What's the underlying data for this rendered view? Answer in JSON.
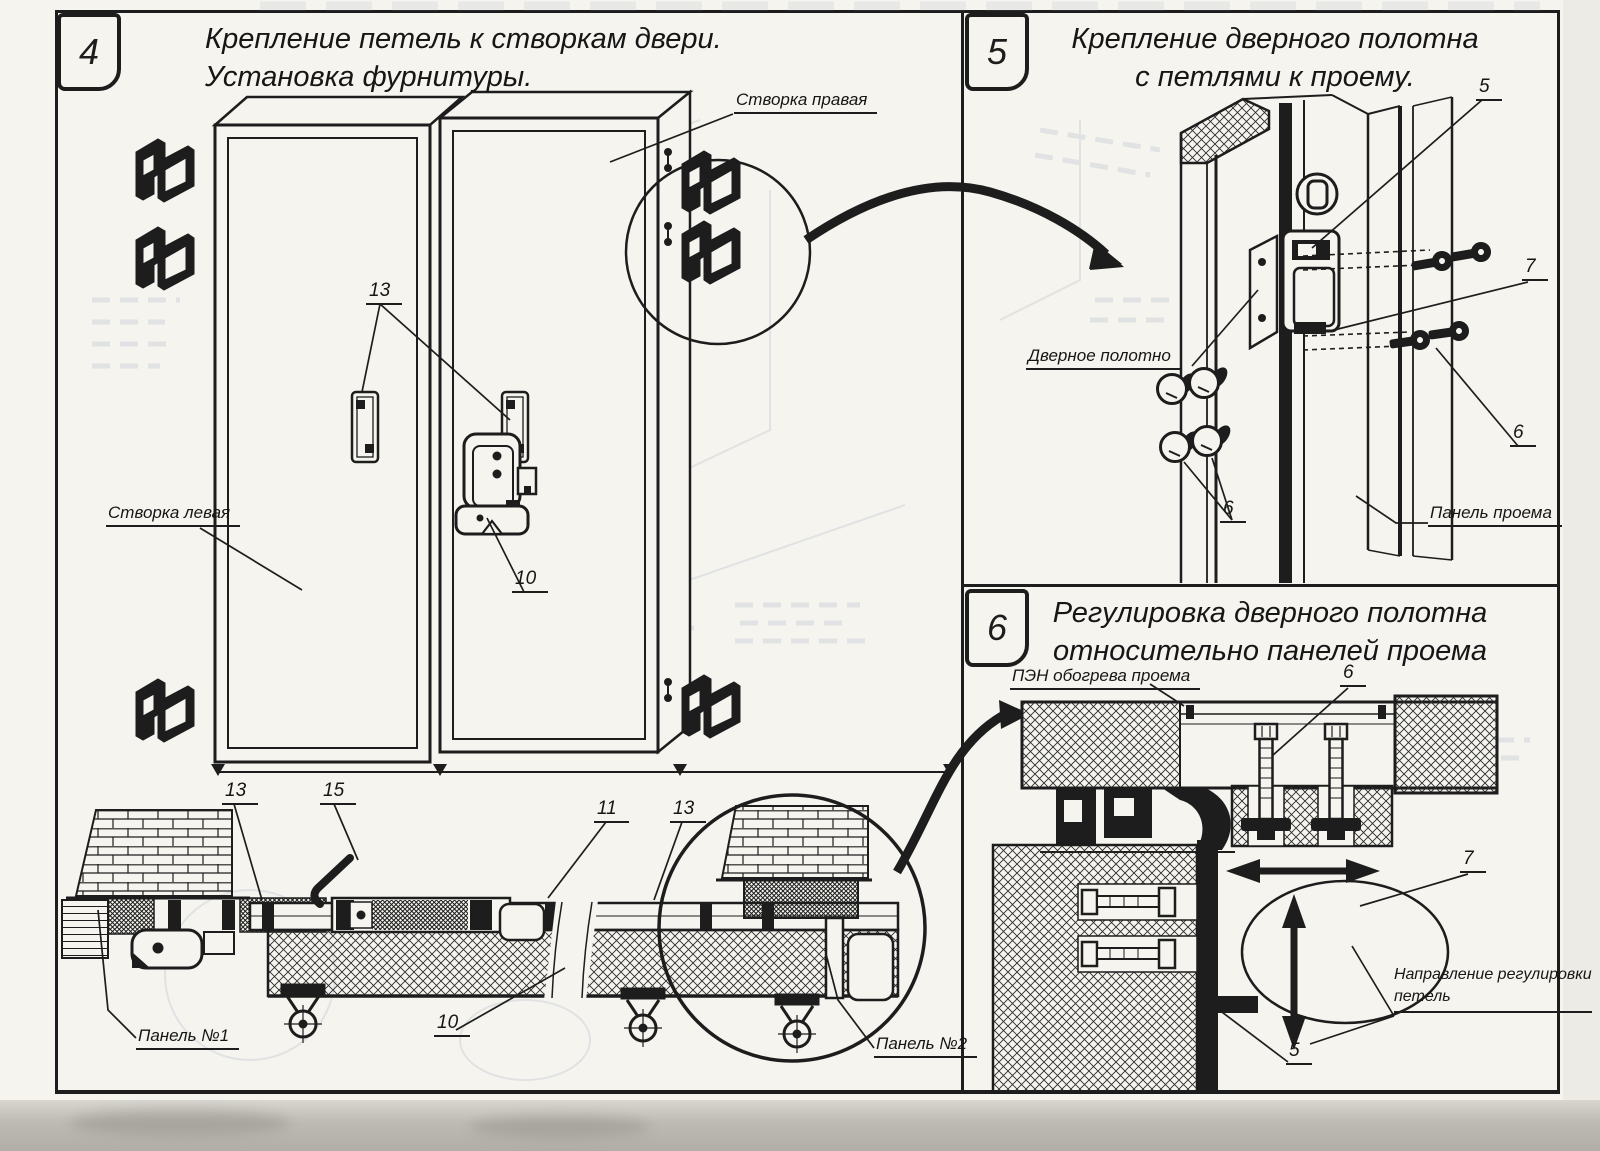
{
  "panels": {
    "panel4": {
      "number": "4",
      "title": [
        "Крепление петель к створкам двери.",
        "Установка фурнитуры."
      ],
      "labels": {
        "leaf_right": "Створка правая",
        "leaf_left": "Створка левая",
        "panel_no1": "Панель №1",
        "panel_no2": "Панель №2"
      },
      "callouts": {
        "hinge_plates": "13",
        "latch": "10",
        "bottom_13_left": "13",
        "bottom_15": "15",
        "bottom_11": "11",
        "bottom_13_right": "13",
        "bottom_10": "10"
      }
    },
    "panel5": {
      "number": "5",
      "title": [
        "Крепление дверного полотна",
        "с петлями к проему."
      ],
      "labels": {
        "door_leaf": "Дверное полотно",
        "opening_panel": "Панель проема"
      },
      "callouts": {
        "top_5": "5",
        "right_7": "7",
        "right_6": "6",
        "left_6": "6"
      }
    },
    "panel6": {
      "number": "6",
      "title": [
        "Регулировка дверного полотна",
        "относительно панелей проема"
      ],
      "labels": {
        "pen_heater": "ПЭН обогрева проема",
        "direction": [
          "Направление регулировки",
          "петель"
        ]
      },
      "callouts": {
        "top_6": "6",
        "mid_7": "7",
        "bottom_5": "5"
      }
    },
    "colors": {
      "ink": "#1d1d1d",
      "paper": "#f5f4ef"
    }
  }
}
